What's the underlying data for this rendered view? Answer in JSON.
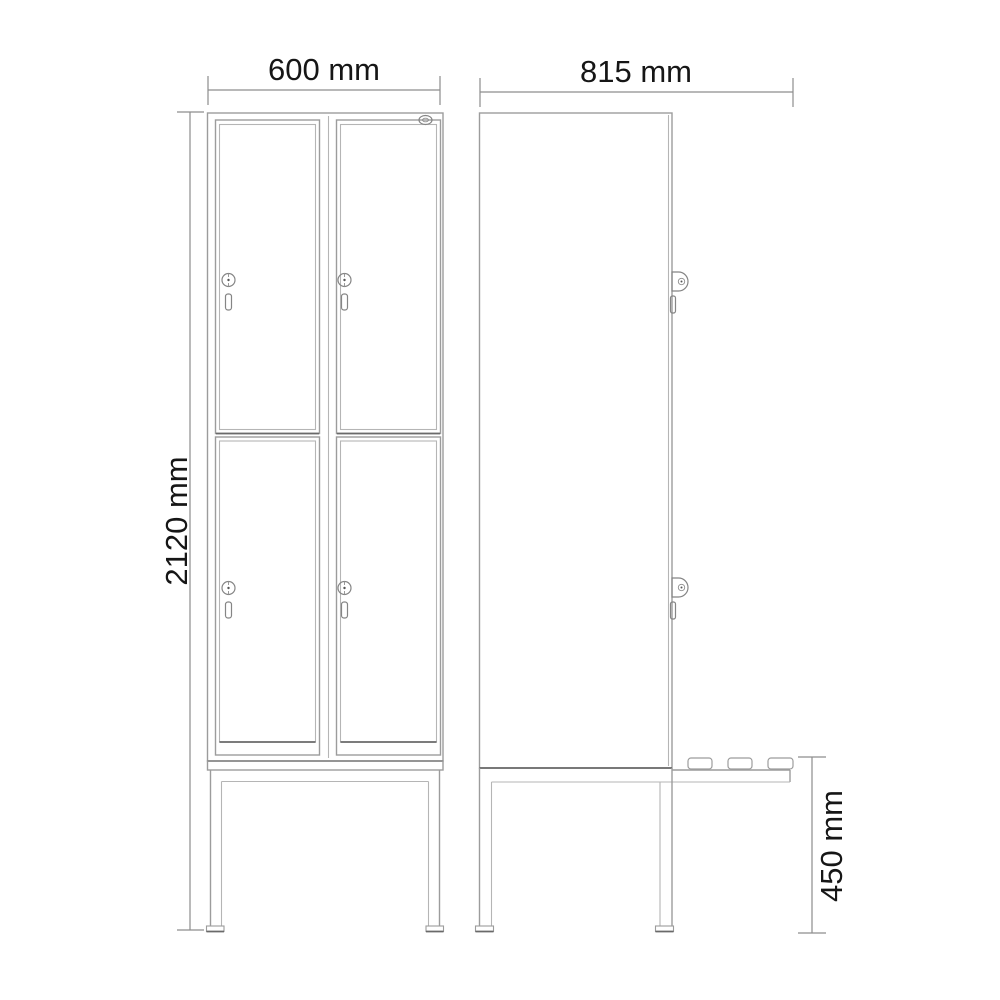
{
  "page": {
    "background_color": "#ffffff",
    "description": "Technical dimension drawing of a two-column, four-door locker on a bench stand: front view and side view"
  },
  "drawing": {
    "colors": {
      "line": "#9c9c9c",
      "line_dark": "#6a6a6a",
      "dimension_line": "#8d8d8d",
      "text": "#161616"
    },
    "views": {
      "front": {
        "width_label": "600 mm",
        "height_label": "2120 mm",
        "door_count": 4,
        "lock_count": 4
      },
      "side": {
        "depth_label": "815 mm",
        "bench_height_label": "450 mm",
        "lock_count": 2,
        "bench_slat_count": 3
      }
    },
    "icons": {
      "lock": "cylinder-lock-icon",
      "handle": "door-handle-icon",
      "logo": "brand-logo-icon",
      "slat": "bench-slat"
    }
  }
}
